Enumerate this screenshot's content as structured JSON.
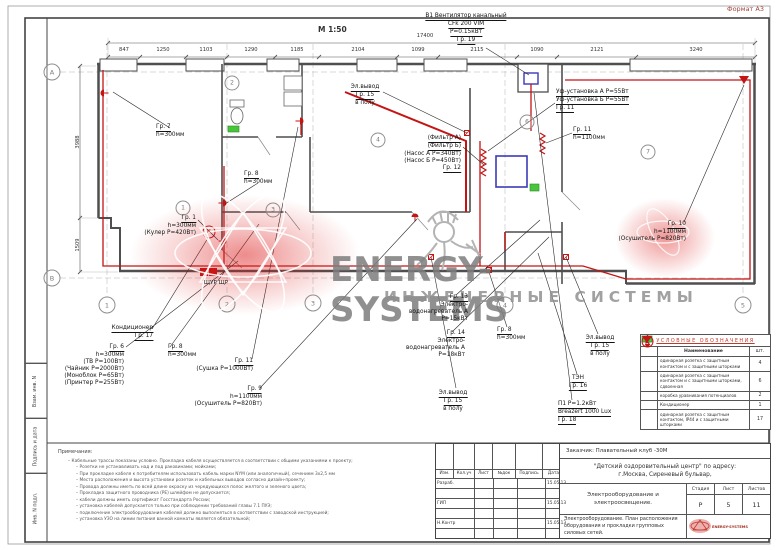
{
  "sheet": {
    "format": "Формат А3",
    "scale": "М 1:50"
  },
  "watermark": {
    "brand": "ENERGY-SYSTEMS",
    "tagline": "ИНЖЕНЕРНЫЕ СИСТЕМЫ"
  },
  "side_stamp": {
    "cells": [
      {
        "label": "Взам. инв. N"
      },
      {
        "label": "Подпись и дата"
      },
      {
        "label": "Инв. N подл."
      }
    ]
  },
  "plan": {
    "dim_total": {
      "t": "17400",
      "x": 425,
      "y": 33
    },
    "dims_top": [
      {
        "t": "847",
        "x": 124,
        "y": 47
      },
      {
        "t": "1250",
        "x": 163,
        "y": 47
      },
      {
        "t": "1103",
        "x": 206,
        "y": 47
      },
      {
        "t": "1290",
        "x": 251,
        "y": 47
      },
      {
        "t": "1185",
        "x": 297,
        "y": 47
      },
      {
        "t": "2104",
        "x": 358,
        "y": 47
      },
      {
        "t": "1099",
        "x": 418,
        "y": 47
      },
      {
        "t": "2115",
        "x": 477,
        "y": 47
      },
      {
        "t": "1090",
        "x": 537,
        "y": 47
      },
      {
        "t": "2121",
        "x": 597,
        "y": 47
      },
      {
        "t": "3240",
        "x": 696,
        "y": 47
      }
    ],
    "dims_left": [
      {
        "t": "3988",
        "x": 78,
        "y": 142
      },
      {
        "t": "1509",
        "x": 78,
        "y": 245
      }
    ],
    "axis_circles": [
      {
        "t": "А",
        "x": 52,
        "y": 72
      },
      {
        "t": "В",
        "x": 52,
        "y": 278
      }
    ],
    "grid_circles": [
      {
        "t": "1",
        "x": 107,
        "y": 305
      },
      {
        "t": "2",
        "x": 227,
        "y": 304
      },
      {
        "t": "3",
        "x": 313,
        "y": 303
      },
      {
        "t": "4",
        "x": 505,
        "y": 305
      },
      {
        "t": "5",
        "x": 743,
        "y": 305
      }
    ],
    "room_circles": [
      {
        "t": "1",
        "x": 183,
        "y": 208
      },
      {
        "t": "2",
        "x": 232,
        "y": 83
      },
      {
        "t": "3",
        "x": 273,
        "y": 210
      },
      {
        "t": "4",
        "x": 378,
        "y": 140
      },
      {
        "t": "6",
        "x": 527,
        "y": 122
      },
      {
        "t": "7",
        "x": 648,
        "y": 152
      }
    ],
    "panel_label": {
      "t": "ЩУР ЩР",
      "x": 216,
      "y": 280
    },
    "misc_labels": [
      {
        "t": "К",
        "x": 209,
        "y": 232
      }
    ],
    "callouts": [
      {
        "x": 466,
        "y": 13,
        "align": "center",
        "lines": [
          {
            "t": "В1 Вентилятор канальный",
            "u": true
          },
          {
            "t": "CFk 200 VIM",
            "u": true
          },
          {
            "t": "P=0.15кВт",
            "u": true
          },
          {
            "t": "Гр. 19",
            "u": true
          }
        ]
      },
      {
        "x": 365,
        "y": 84,
        "align": "center",
        "lines": [
          {
            "t": "Эл.вывод",
            "u": true
          },
          {
            "t": "Гр. 15",
            "u": true
          },
          {
            "t": "в полу",
            "u": false
          }
        ]
      },
      {
        "x": 556,
        "y": 89,
        "align": "left",
        "lines": [
          {
            "t": "Уф-установка А P=55Вт",
            "u": true
          },
          {
            "t": "Уф-установка Б P=55Вт",
            "u": true
          },
          {
            "t": "Гр. 11",
            "u": true
          }
        ]
      },
      {
        "x": 573,
        "y": 127,
        "align": "left",
        "lines": [
          {
            "t": "Гр. 11",
            "u": true
          },
          {
            "t": "h=1100мм",
            "u": false
          }
        ]
      },
      {
        "x": 461,
        "y": 135,
        "align": "right",
        "lines": [
          {
            "t": "(Фильтр А)",
            "u": true
          },
          {
            "t": "(Фильтр Б)",
            "u": true
          },
          {
            "t": "(Насос А P=340Вт)",
            "u": false
          },
          {
            "t": "(Насос Б P=450Вт)",
            "u": false
          },
          {
            "t": "Гр. 12",
            "u": true
          }
        ]
      },
      {
        "x": 156,
        "y": 124,
        "align": "left",
        "lines": [
          {
            "t": "Гр. 7",
            "u": true
          },
          {
            "t": "h=300мм",
            "u": false
          }
        ]
      },
      {
        "x": 244,
        "y": 171,
        "align": "left",
        "lines": [
          {
            "t": "Гр. 8",
            "u": true
          },
          {
            "t": "h=300мм",
            "u": false
          }
        ]
      },
      {
        "x": 196,
        "y": 215,
        "align": "right",
        "lines": [
          {
            "t": "Гр. 1",
            "u": true
          },
          {
            "t": "h=300мм",
            "u": false
          },
          {
            "t": "(Кулер P=420Вт)",
            "u": false
          }
        ]
      },
      {
        "x": 686,
        "y": 221,
        "align": "right",
        "lines": [
          {
            "t": "Гр. 10",
            "u": true
          },
          {
            "t": "h=1100мм",
            "u": false
          },
          {
            "t": "(Осушитель P=820Вт)",
            "u": false
          }
        ]
      },
      {
        "x": 153,
        "y": 325,
        "align": "right",
        "lines": [
          {
            "t": "Кондиционер",
            "u": true
          },
          {
            "t": "Гр. 17",
            "u": true
          }
        ]
      },
      {
        "x": 124,
        "y": 344,
        "align": "right",
        "lines": [
          {
            "t": "Гр. 6",
            "u": true
          },
          {
            "t": "h=300мм",
            "u": false
          },
          {
            "t": "(ТВ P=100Вт)",
            "u": false
          },
          {
            "t": "(Чайник P=2000Вт)",
            "u": false
          },
          {
            "t": "(Моноблок P=65Вт)",
            "u": false
          },
          {
            "t": "(Принтер P=255Вт)",
            "u": false
          }
        ]
      },
      {
        "x": 168,
        "y": 344,
        "align": "left",
        "lines": [
          {
            "t": "Гр. 8",
            "u": true
          },
          {
            "t": "h=300мм",
            "u": false
          }
        ]
      },
      {
        "x": 253,
        "y": 358,
        "align": "right",
        "lines": [
          {
            "t": "Гр. 11",
            "u": true
          },
          {
            "t": "(Сушка P=1000Вт)",
            "u": false
          }
        ]
      },
      {
        "x": 262,
        "y": 386,
        "align": "right",
        "lines": [
          {
            "t": "Гр. 9",
            "u": true
          },
          {
            "t": "h=1100мм",
            "u": false
          },
          {
            "t": "(Осушитель P=820Вт)",
            "u": false
          }
        ]
      },
      {
        "x": 468,
        "y": 294,
        "align": "right",
        "lines": [
          {
            "t": "Гр. 13",
            "u": true
          },
          {
            "t": "Электро-",
            "u": false
          },
          {
            "t": "водонагреватель А",
            "u": false
          },
          {
            "t": "P=15кВт",
            "u": false
          }
        ]
      },
      {
        "x": 465,
        "y": 330,
        "align": "right",
        "lines": [
          {
            "t": "Гр. 14",
            "u": true
          },
          {
            "t": "Электро-",
            "u": false
          },
          {
            "t": "водонагреватель А",
            "u": false
          },
          {
            "t": "P=18кВт",
            "u": false
          }
        ]
      },
      {
        "x": 497,
        "y": 327,
        "align": "left",
        "lines": [
          {
            "t": "Гр. 8",
            "u": true
          },
          {
            "t": "h=300мм",
            "u": false
          }
        ]
      },
      {
        "x": 453,
        "y": 390,
        "align": "center",
        "lines": [
          {
            "t": "Эл.вывод",
            "u": true
          },
          {
            "t": "Гр. 15",
            "u": true
          },
          {
            "t": "в полу",
            "u": false
          }
        ]
      },
      {
        "x": 600,
        "y": 335,
        "align": "center",
        "lines": [
          {
            "t": "Эл.вывод",
            "u": true
          },
          {
            "t": "Гр. 15",
            "u": true
          },
          {
            "t": "в полу",
            "u": false
          }
        ]
      },
      {
        "x": 578,
        "y": 375,
        "align": "center",
        "lines": [
          {
            "t": "ТЭН",
            "u": true
          },
          {
            "t": "Гр. 16",
            "u": true
          }
        ]
      },
      {
        "x": 558,
        "y": 401,
        "align": "left",
        "lines": [
          {
            "t": "П1 P=1.2кВт",
            "u": true
          },
          {
            "t": "Breazert 1000 Lux",
            "u": true
          },
          {
            "t": "Гр. 18",
            "u": true
          }
        ]
      }
    ]
  },
  "legend": {
    "title": "УСЛОВНЫЕ ОБОЗНАЧЕНИЯ",
    "col_name": "Наименование",
    "col_qty": "шт.",
    "rows": [
      {
        "icon": "socket-single-icon",
        "name": "одинарная розетка с защитным контактом и с защитными шторками",
        "qty": "4"
      },
      {
        "icon": "socket-double-icon",
        "name": "одинарная розетка с защитным контактом и с защитными шторками, сдвоенная",
        "qty": "6"
      },
      {
        "icon": "potential-box-icon",
        "name": "коробка уравнивания потенциалов",
        "qty": "2"
      },
      {
        "icon": "conditioner-icon",
        "name": "Кондиционер",
        "qty": "1"
      },
      {
        "icon": "socket-ip44-icon",
        "name": "одинарная розетка с защитным контактом, IP44 и с защитными шторками",
        "qty": "17"
      }
    ]
  },
  "notes": {
    "title": "Примечания:",
    "items": [
      "Кабельные трассы показаны условно. Прокладка кабеля осуществляется в соответствии с общими указаниями к проекту;",
      "Розетки не устанавливать над и под раковинами; мойками;",
      "При прокладке кабеля к потребителям использовать кабель марки NYM (или аналогичный), сечением 3х2,5 мм",
      "Места расположения и высота установки розеток и кабельных выводов согласно дизайн-проекту;",
      "Провода должны иметь по всей длине окраску из чередующихся полос желтого и зеленого цвета;",
      "Прокладка защитного проводника (PE) шлейфом не допускается;",
      "кабели должны иметь сертификат Госстандарта России;",
      "установка кабелей допускается только при соблюдении требований главы 7.1 ПУЭ;",
      "подключение электрооборудования кабелей должно выполняться в соответствии с заводской инструкцией;",
      "установка УЗО на линии питания ванной комнаты является обязательной;"
    ]
  },
  "title_block": {
    "customer": "Заказчик: Плавательный клуб -30М",
    "address_line1": "\"Детский оздоровительный центр\" по адресу:",
    "address_line2": "г.Москва, Сиреневый бульвар,",
    "sig_headers": [
      "Изм.",
      "Кол.уч",
      "Лист",
      "№док",
      "Подпись",
      "Дата"
    ],
    "sig_rows": [
      {
        "role": "Разраб.",
        "date": "15.05.13"
      },
      {
        "role": "",
        "date": ""
      },
      {
        "role": "ГИП",
        "date": "15.05.13"
      },
      {
        "role": "",
        "date": ""
      },
      {
        "role": "Н.Контр",
        "date": "15.05.13"
      },
      {
        "role": "",
        "date": ""
      }
    ],
    "doc_title1": "Электрооборудование и электроосвещение.",
    "doc_title2": "Электрооборудование. План расположения оборудования и прокладки групповых силовых сетей.",
    "stage_label": "Стадия",
    "sheet_label": "Лист",
    "sheets_label": "Листов",
    "stage": "Р",
    "sheet": "5",
    "sheets": "11"
  },
  "colors": {
    "cable_red": "#c41414",
    "pool_blue": "#3a3ab8",
    "ground_green": "#49c53c",
    "wall_gray": "#4f4f4f"
  }
}
